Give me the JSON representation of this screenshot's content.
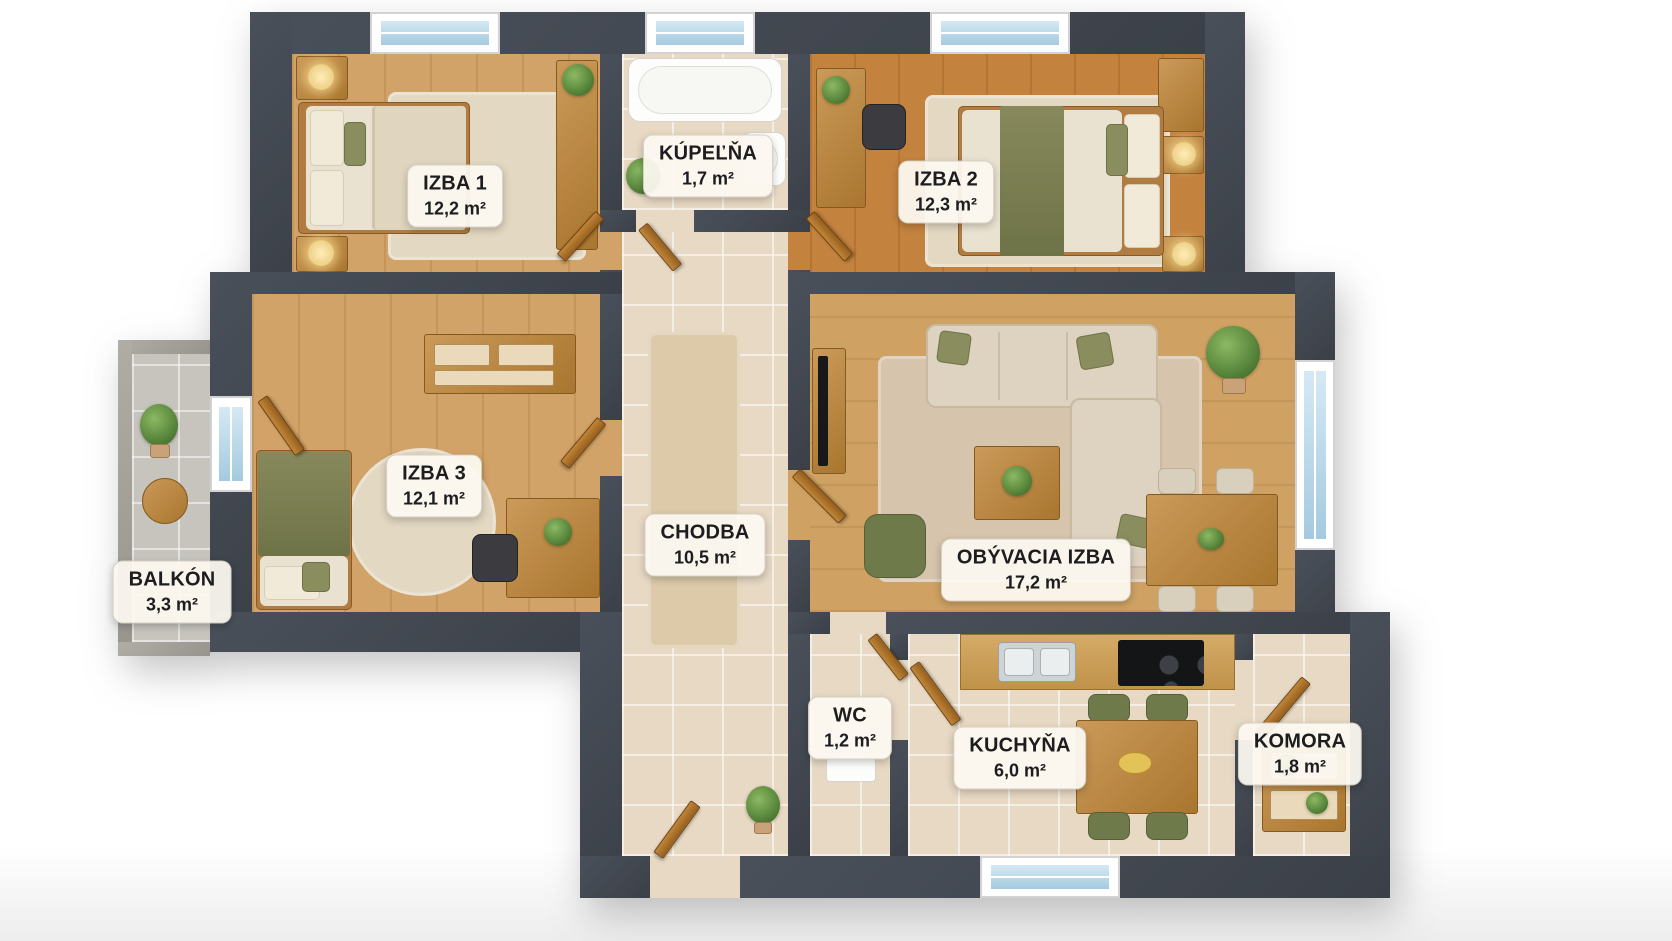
{
  "meta": {
    "kind": "3d-apartment-floor-plan",
    "background": "#ffffff"
  },
  "colors": {
    "wall": "#41464e",
    "balcony_wall": "#a6a39d",
    "wood_floor_light": "#d2a368",
    "wood_floor_orange": "#c4823f",
    "wood_floor_living": "#cfa263",
    "tile_floor": "#e7d9c3",
    "balcony_floor": "#c7c4be",
    "accent_green": "#6f7a4a",
    "door_wood": "#b5762e",
    "window_glass": "#bcd9ea",
    "label_bg": "#fcf8f0",
    "label_text": "#1d1d1f"
  },
  "rooms": [
    {
      "id": "izba1",
      "name": "IZBA 1",
      "area": "12,2 m²"
    },
    {
      "id": "kupelna",
      "name": "KÚPEĽŇA",
      "area": "1,7 m²"
    },
    {
      "id": "izba2",
      "name": "IZBA 2",
      "area": "12,3 m²"
    },
    {
      "id": "izba3",
      "name": "IZBA 3",
      "area": "12,1 m²"
    },
    {
      "id": "chodba",
      "name": "CHODBA",
      "area": "10,5 m²"
    },
    {
      "id": "obyvacia_izba",
      "name": "OBÝVACIA IZBA",
      "area": "17,2 m²"
    },
    {
      "id": "balkon",
      "name": "BALKÓN",
      "area": "3,3 m²"
    },
    {
      "id": "wc",
      "name": "WC",
      "area": "1,2 m²"
    },
    {
      "id": "kuchyna",
      "name": "KUCHYŇA",
      "area": "6,0 m²"
    },
    {
      "id": "komora",
      "name": "KOMORA",
      "area": "1,8 m²"
    }
  ]
}
